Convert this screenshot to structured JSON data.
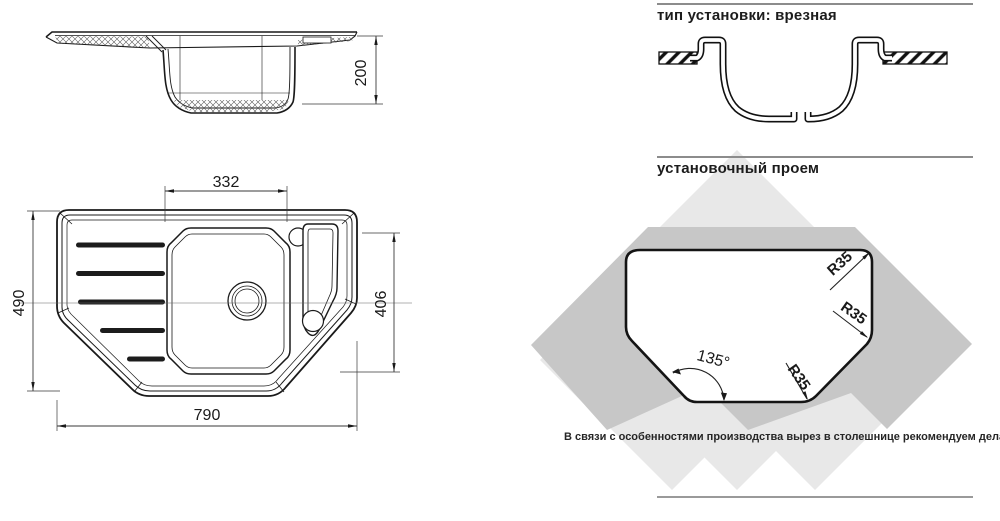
{
  "side_view": {
    "dim_depth": "200"
  },
  "top_view": {
    "dim_bowl_width": "332",
    "dim_overall_depth": "490",
    "dim_right_depth": "406",
    "dim_overall_width": "790"
  },
  "installation": {
    "heading": "тип установки: врезная"
  },
  "cutout": {
    "heading": "установочный проем",
    "radius_top_right": "R35",
    "radius_right": "R35",
    "radius_bottom": "R35",
    "corner_angle": "135°",
    "production_note": "В связи с особенностями производства вырез в столешнице рекомендуем делать с изделия."
  },
  "colors": {
    "line": "#1a1a1a",
    "dim_line": "#3a3a3a",
    "watermark_light": "#e8e8e8",
    "watermark_dark": "#c7c7c7",
    "rule": "#8c8c8c"
  }
}
